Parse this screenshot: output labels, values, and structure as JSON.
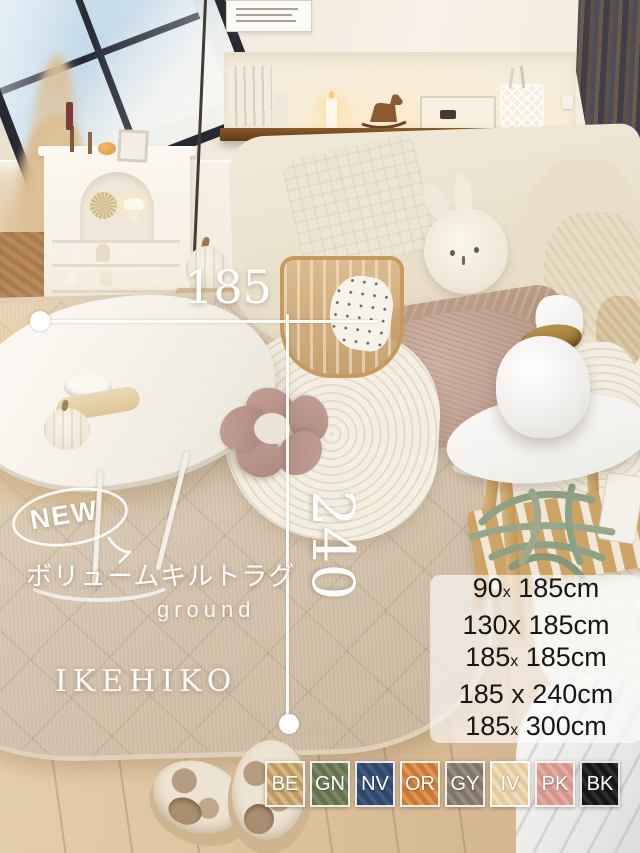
{
  "photo": {
    "brand": "IKEHIKO",
    "product_title_ja": "ボリュームキルトラグ",
    "product_series": "ground",
    "badge": "NEW",
    "dimension_width": "185",
    "dimension_length": "240"
  },
  "size_list": {
    "rows": [
      {
        "pre": "90",
        "x": "x",
        "post": " 185cm"
      },
      {
        "pre": "130",
        "x": "x",
        "post": " 185cm"
      },
      {
        "pre": "185",
        "x": "x",
        "post": " 185cm"
      },
      {
        "pre": "185 ",
        "x": "x",
        "post": " 240cm"
      },
      {
        "pre": "185",
        "x": "x",
        "post": " 300cm"
      }
    ]
  },
  "color_swatches": [
    {
      "code": "BE",
      "name": "beige",
      "hex": "#c09a63",
      "stripe": "#d7b988"
    },
    {
      "code": "GN",
      "name": "green",
      "hex": "#64734e",
      "stripe": "#7c8b64"
    },
    {
      "code": "NV",
      "name": "navy",
      "hex": "#2e486a",
      "stripe": "#41597e"
    },
    {
      "code": "OR",
      "name": "orange",
      "hex": "#c97a36",
      "stripe": "#e29554"
    },
    {
      "code": "GY",
      "name": "gray",
      "hex": "#81756a",
      "stripe": "#998c7f"
    },
    {
      "code": "IV",
      "name": "ivory",
      "hex": "#e2cb9f",
      "stripe": "#efddb9"
    },
    {
      "code": "PK",
      "name": "pink",
      "hex": "#d4968b",
      "stripe": "#e2aca1"
    },
    {
      "code": "BK",
      "name": "black",
      "hex": "#161616",
      "stripe": "#2d2d2d"
    }
  ]
}
